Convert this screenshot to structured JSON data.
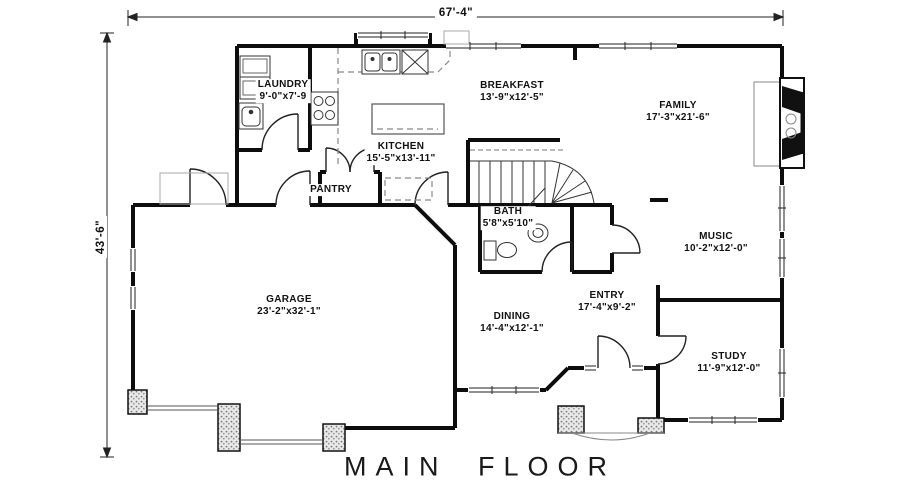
{
  "title": "MAIN FLOOR",
  "dimensions": {
    "overall_width": "67'-4\"",
    "overall_height": "43'-6\""
  },
  "rooms": [
    {
      "name": "LAUNDRY",
      "size": "9'-0\"x7'-9"
    },
    {
      "name": "KITCHEN",
      "size": "15'-5\"x13'-11\""
    },
    {
      "name": "BREAKFAST",
      "size": "13'-9\"x12'-5\""
    },
    {
      "name": "FAMILY",
      "size": "17'-3\"x21'-6\""
    },
    {
      "name": "PANTRY",
      "size": ""
    },
    {
      "name": "BATH",
      "size": "5'8\"x5'10\""
    },
    {
      "name": "MUSIC",
      "size": "10'-2\"x12'-0\""
    },
    {
      "name": "GARAGE",
      "size": "23'-2\"x32'-1\""
    },
    {
      "name": "DINING",
      "size": "14'-4\"x12'-1\""
    },
    {
      "name": "ENTRY",
      "size": "17'-4\"x9'-2\""
    },
    {
      "name": "STUDY",
      "size": "11'-9\"x12'-0\""
    }
  ],
  "colors": {
    "wall": "#0d0d0d",
    "thin_line": "#333333",
    "counter_dash": "#888888",
    "pier_dot": "#777777"
  }
}
